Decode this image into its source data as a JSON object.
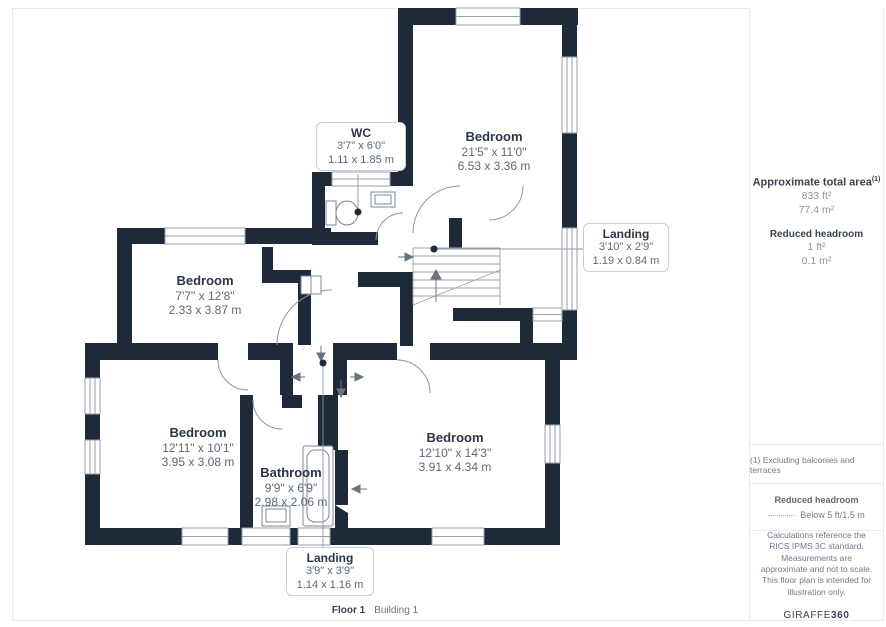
{
  "plan": {
    "rooms": [
      {
        "name": "Bedroom",
        "imperial": "21'5\" x 11'0\"",
        "metric": "6.53 x 3.36 m"
      },
      {
        "name": "Bedroom",
        "imperial": "7'7\" x 12'8\"",
        "metric": "2.33 x 3.87 m"
      },
      {
        "name": "Bedroom",
        "imperial": "12'11\" x 10'1\"",
        "metric": "3.95 x 3.08 m"
      },
      {
        "name": "Bathroom",
        "imperial": "9'9\" x 6'9\"",
        "metric": "2.98 x 2.06 m"
      },
      {
        "name": "Bedroom",
        "imperial": "12'10\" x 14'3\"",
        "metric": "3.91 x 4.34 m"
      }
    ],
    "callouts": [
      {
        "name": "WC",
        "imperial": "3'7\" x 6'0\"",
        "metric": "1.11 x 1.85 m"
      },
      {
        "name": "Landing",
        "imperial": "3'10\" x 2'9\"",
        "metric": "1.19 x 0.84 m"
      },
      {
        "name": "Landing",
        "imperial": "3'9\" x 3'9\"",
        "metric": "1.14 x 1.16 m"
      }
    ],
    "caption": {
      "floor": "Floor 1",
      "building": "Building 1"
    },
    "colors": {
      "wall": "#1f2a38",
      "line": "#8e96a3"
    }
  },
  "sidebar": {
    "total_area": {
      "title": "Approximate total area",
      "sup": "(1)",
      "imperial": "833 ft²",
      "metric": "77.4 m²"
    },
    "reduced_headroom": {
      "title": "Reduced headroom",
      "imperial": "1 ft²",
      "metric": "0.1 m²"
    },
    "footnote": "(1) Excluding balconies and terraces",
    "legend": {
      "title": "Reduced headroom",
      "label": "Below 5 ft/1.5 m"
    },
    "disclaimer": "Calculations reference the RICS IPMS 3C standard. Measurements are approximate and not to scale. This floor plan is intended for illustration only.",
    "brand": {
      "name": "GIRAFFE",
      "suffix": "360"
    }
  }
}
